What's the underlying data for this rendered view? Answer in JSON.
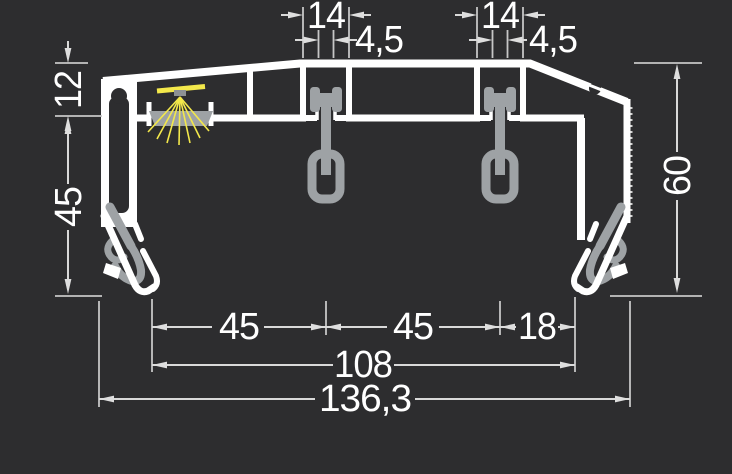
{
  "colors": {
    "background": "#2d2d2f",
    "profile_white": "#ffffff",
    "dimension_lines": "#d9d9d9",
    "dimension_text": "#ffffff",
    "hardware_gray": "#9ea2a5",
    "led_yellow": "#f3e84b"
  },
  "dimensions": {
    "top_left_slot_width": "14",
    "top_left_slot_opening": "4,5",
    "top_right_slot_width": "14",
    "top_right_slot_opening": "4,5",
    "left_upper_depth": "12",
    "left_side_height": "45",
    "right_total_height": "60",
    "bottom_span_left": "45",
    "bottom_span_mid": "45",
    "bottom_span_right": "18",
    "bottom_inner_total": "108",
    "bottom_overall_width": "136,3"
  }
}
